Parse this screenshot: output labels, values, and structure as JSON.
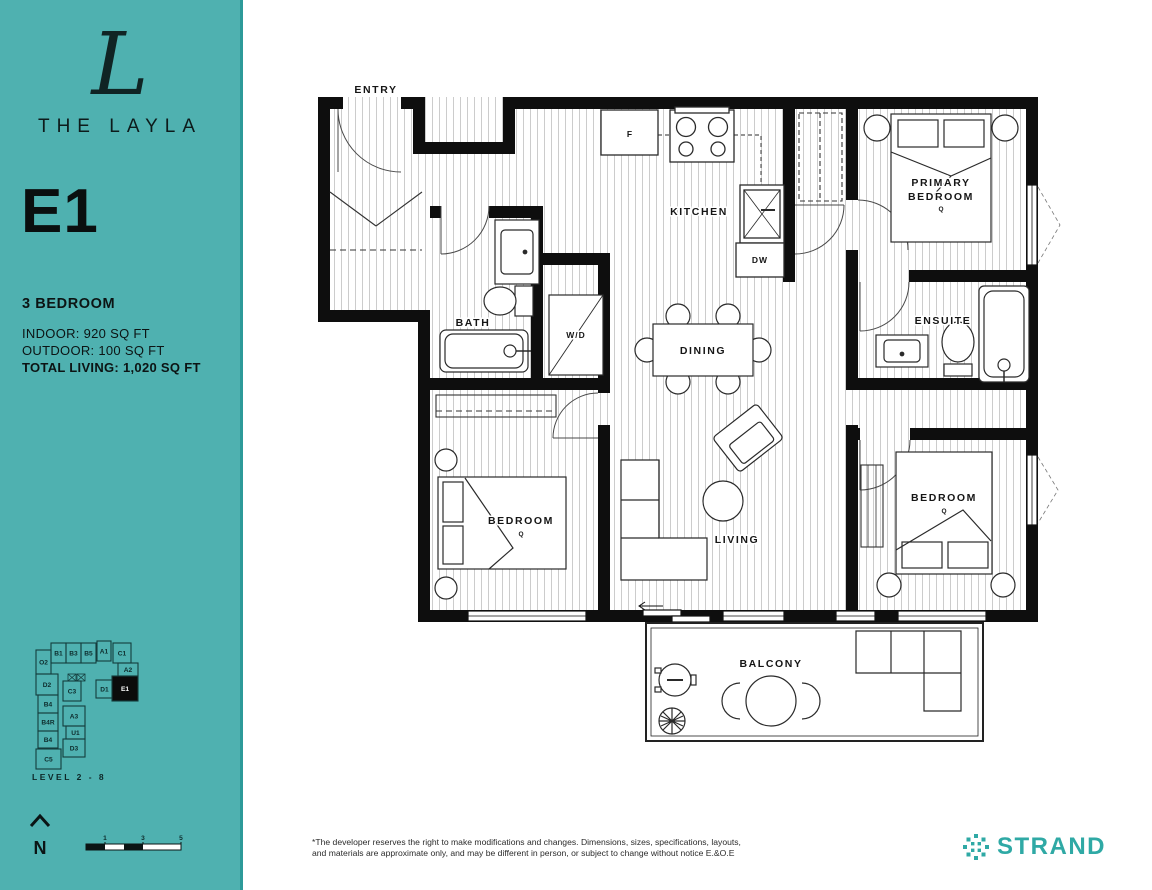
{
  "colors": {
    "sidebar_teal": "#4FB1B0",
    "sidebar_edge": "#2D9A99",
    "strand_teal": "#2FA9A5",
    "wall_black": "#0e0e0e"
  },
  "sidebar": {
    "logo_letter": "L",
    "brand": "THE LAYLA",
    "unit": "E1",
    "unit_type": "3 BEDROOM",
    "indoor": "INDOOR: 920 SQ FT",
    "outdoor": "OUTDOOR: 100 SQ FT",
    "total": "TOTAL LIVING: 1,020 SQ FT",
    "keyplan": {
      "level_label": "LEVEL 2 - 8",
      "highlighted_unit": "E1",
      "units": [
        {
          "label": "B1",
          "x": 23,
          "y": 3,
          "w": 15,
          "h": 20,
          "filled": false
        },
        {
          "label": "B3",
          "x": 38,
          "y": 3,
          "w": 15,
          "h": 20,
          "filled": false
        },
        {
          "label": "B5",
          "x": 53,
          "y": 3,
          "w": 15,
          "h": 20,
          "filled": false
        },
        {
          "label": "A1",
          "x": 69,
          "y": 1,
          "w": 14,
          "h": 20,
          "filled": false
        },
        {
          "label": "C1",
          "x": 85,
          "y": 3,
          "w": 18,
          "h": 20,
          "filled": false
        },
        {
          "label": "O2",
          "x": 8,
          "y": 10,
          "w": 15,
          "h": 24,
          "filled": false
        },
        {
          "label": "A2",
          "x": 90,
          "y": 23,
          "w": 20,
          "h": 13,
          "filled": false
        },
        {
          "label": "D2",
          "x": 8,
          "y": 34,
          "w": 22,
          "h": 21,
          "filled": false
        },
        {
          "label": "C3",
          "x": 35,
          "y": 41,
          "w": 18,
          "h": 20,
          "filled": false
        },
        {
          "label": "D1",
          "x": 68,
          "y": 40,
          "w": 17,
          "h": 18,
          "filled": false
        },
        {
          "label": "E1",
          "x": 84,
          "y": 36,
          "w": 26,
          "h": 25,
          "filled": true
        },
        {
          "label": "B4",
          "x": 10,
          "y": 55,
          "w": 20,
          "h": 18,
          "filled": false
        },
        {
          "label": "B4R",
          "x": 10,
          "y": 73,
          "w": 20,
          "h": 18,
          "filled": false
        },
        {
          "label": "B4",
          "x": 10,
          "y": 91,
          "w": 20,
          "h": 17,
          "filled": false
        },
        {
          "label": "A3",
          "x": 35,
          "y": 66,
          "w": 22,
          "h": 20,
          "filled": false
        },
        {
          "label": "U1",
          "x": 38,
          "y": 86,
          "w": 19,
          "h": 13,
          "filled": false
        },
        {
          "label": "D3",
          "x": 35,
          "y": 99,
          "w": 22,
          "h": 18,
          "filled": false
        },
        {
          "label": "C5",
          "x": 8,
          "y": 109,
          "w": 25,
          "h": 20,
          "filled": false
        }
      ]
    },
    "north_label": "N",
    "scale": {
      "ticks": [
        "1",
        "3",
        "5"
      ]
    }
  },
  "plan": {
    "entry": "ENTRY",
    "kitchen": "KITCHEN",
    "fridge": "F",
    "dishwasher": "DW",
    "bath": "BATH",
    "washer_dryer": "W/D",
    "dining": "DINING",
    "living": "LIVING",
    "balcony": "BALCONY",
    "primary_line1": "PRIMARY",
    "primary_line2": "BEDROOM",
    "ensuite": "ENSUITE",
    "bedroom": "BEDROOM",
    "queen": "Q"
  },
  "footer": {
    "disclaimer_line1": "*The developer reserves the right to make modifications and changes. Dimensions, sizes, specifications, layouts,",
    "disclaimer_line2": "and materials are approximate only, and may be different in person, or subject to change without notice E.&O.E",
    "brand": "STRAND"
  }
}
